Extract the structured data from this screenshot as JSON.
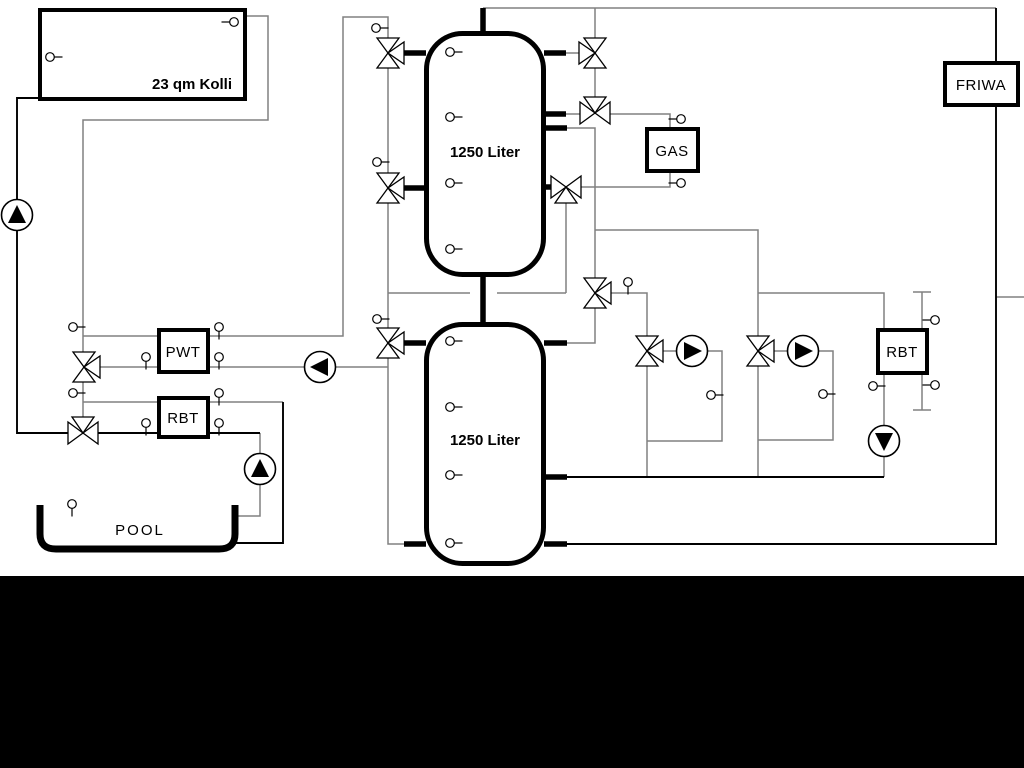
{
  "diagram": {
    "title_hint": "heating / solar / pool hydraulic schematic",
    "labels": {
      "collector": "23 qm Kolli",
      "tank1": "1250 Liter",
      "tank2": "1250 Liter",
      "gas": "GAS",
      "friwa": "FRIWA",
      "pwt": "PWT",
      "rbt_left": "RBT",
      "rbt_right": "RBT",
      "pool": "POOL"
    },
    "colors": {
      "background": "#ffffff",
      "pipe_gray": "#808080",
      "pipe_black": "#000000",
      "component_outline": "#000000",
      "component_fill": "#ffffff",
      "bottom_bar": "#000000"
    }
  }
}
